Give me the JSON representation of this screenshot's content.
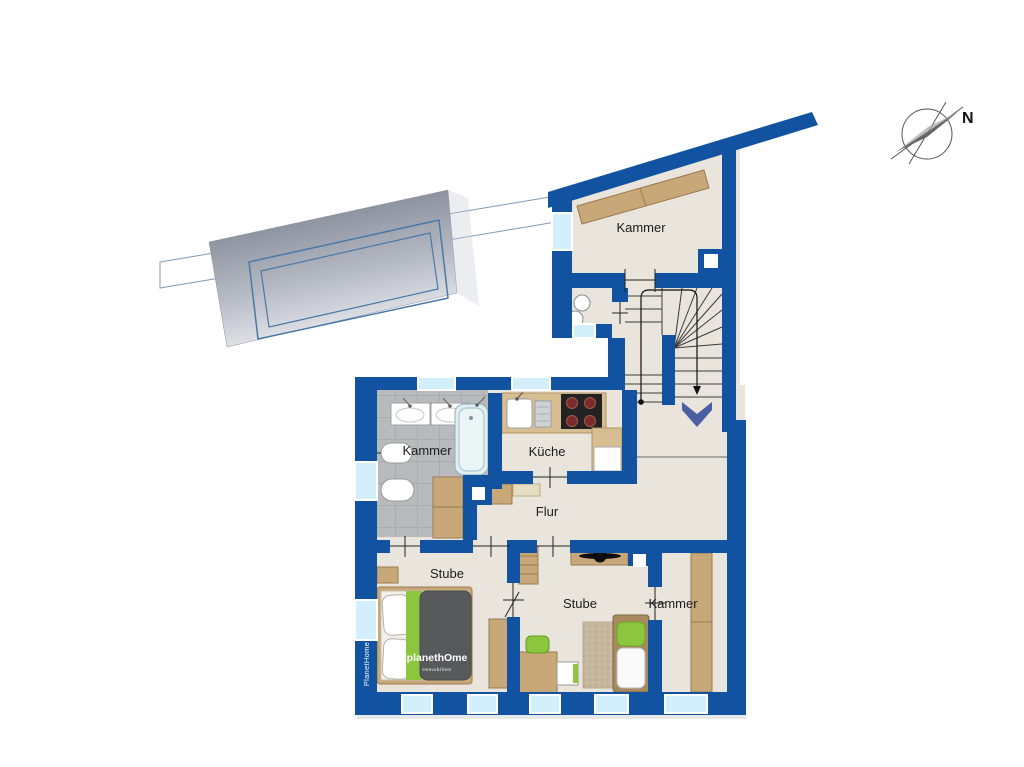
{
  "page": "floor-plan",
  "compass": {
    "label": "N"
  },
  "rooms": [
    {
      "key": "kammer-top",
      "label": "Kammer"
    },
    {
      "key": "bad-kammer",
      "label": "Kammer"
    },
    {
      "key": "kueche",
      "label": "Küche"
    },
    {
      "key": "flur",
      "label": "Flur"
    },
    {
      "key": "stube-west",
      "label": "Stube"
    },
    {
      "key": "stube-ost",
      "label": "Stube"
    },
    {
      "key": "kammer-ost",
      "label": "Kammer"
    }
  ],
  "branding": {
    "logo": "planethOme",
    "logo_sub": "Immobilien",
    "watermark": "PlanetHome"
  },
  "colors": {
    "wall": "#1153a1",
    "floor": "#e9e5dc",
    "tile": "#b9babc",
    "window_glass": "#d2effb",
    "furniture_wood": "#c8a878",
    "accent_green": "#8cc63e",
    "blanket_gray": "#58595b",
    "stair_arrow": "#4b5fa3",
    "roof_dark": "#7b8290",
    "roof_light": "#f1f2f5",
    "roof_outline": "#4a79a8"
  }
}
